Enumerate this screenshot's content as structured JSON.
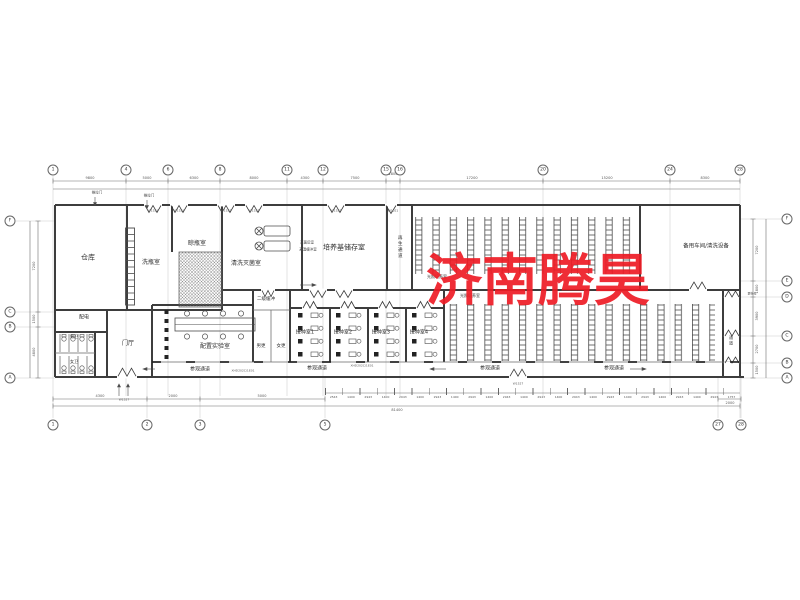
{
  "watermark": {
    "text": "济南腾昊",
    "color": "#ee1c25"
  },
  "grid": {
    "top": [
      {
        "n": "1"
      },
      {
        "n": "4"
      },
      {
        "n": "6"
      },
      {
        "n": "8"
      },
      {
        "n": "11"
      },
      {
        "n": "12"
      },
      {
        "n": "15"
      },
      {
        "n": "16"
      },
      {
        "n": "20"
      },
      {
        "n": "24"
      },
      {
        "n": "28"
      }
    ],
    "bottom_left": [
      {
        "n": "1"
      },
      {
        "n": "2"
      },
      {
        "n": "3"
      },
      {
        "n": "5"
      }
    ],
    "bottom_right": [
      {
        "n": "27"
      },
      {
        "n": "28"
      }
    ],
    "left": [
      {
        "n": "F"
      },
      {
        "n": "C"
      },
      {
        "n": "B"
      },
      {
        "n": "A"
      }
    ],
    "right": [
      {
        "n": "F"
      },
      {
        "n": "E"
      },
      {
        "n": "D"
      },
      {
        "n": "C"
      },
      {
        "n": "B"
      },
      {
        "n": "A"
      }
    ]
  },
  "dims": {
    "top": [
      "9800",
      "5000",
      "6300",
      "8000",
      "4300",
      "7500",
      "1800",
      "17200",
      "15200",
      "8300"
    ],
    "bottom_left": [
      "4300",
      "2000",
      "5000"
    ],
    "left": [
      "7200",
      "1500",
      "4800"
    ],
    "right": [
      "7200",
      "1800",
      "3900",
      "2700",
      "1500"
    ],
    "corridor": "2000",
    "bottom_total": "81400",
    "series": [
      "2543",
      "1400",
      "2943",
      "1400",
      "2943",
      "1400",
      "2943",
      "1400",
      "2943",
      "1400",
      "2943",
      "1400",
      "2943",
      "1400",
      "2943",
      "1400",
      "2943",
      "1400",
      "2943",
      "1400",
      "2943",
      "1400",
      "2943",
      "1757"
    ]
  },
  "rooms": {
    "warehouse": "仓库",
    "bottle_wash": "洗瓶室",
    "bottle_dry": "晾瓶室",
    "wash_sterilize": "清洗灭菌室",
    "post_sterilize": "灭菌后室",
    "hot_buffer": "高温缓冲室",
    "medium_storage": "培养基储存室",
    "regen_corridor": "再生通道",
    "upper_culture": "光照培养室",
    "spare_workshop": "备用车间/清洗设备",
    "power": "配电",
    "men_wc": "男卫",
    "women_wc": "女卫",
    "foyer": "门厅",
    "prep_lab": "配置实验室",
    "buffer2": "二级缓冲",
    "men_change": "男更",
    "women_change": "女更",
    "inoc1": "接种室1",
    "inoc2": "接种室2",
    "inoc3": "接种室3",
    "inoc4": "接种室4",
    "lower_culture": "光照培养室",
    "visit1": "参观通道",
    "visit2": "参观通道",
    "visit3": "参观通道",
    "visit4": "参观通道",
    "side_corridor": "通道",
    "shoe_change": "更鞋处"
  },
  "annotations": {
    "push_door1": "推拉门",
    "push_door2": "推拉门",
    "code1": "XHD202C/1E01",
    "code2": "XHD202C/1E01",
    "door_w1521": "W1521",
    "door_w1527": "W1527",
    "door_w1021": "W1021"
  }
}
